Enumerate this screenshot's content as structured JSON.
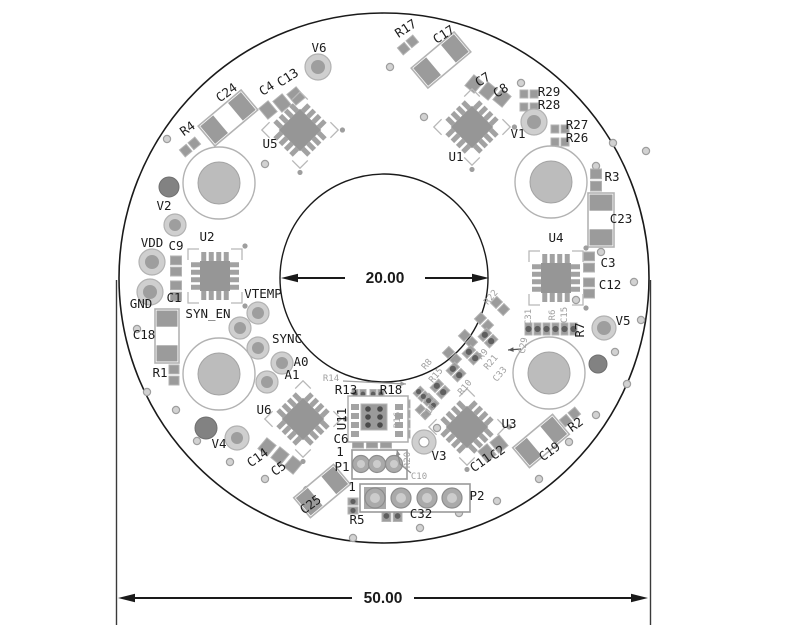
{
  "drawing_type": "pcb-assembly-drawing",
  "dimensions": {
    "inner_diameter": {
      "label": "20.00"
    },
    "outer_diameter": {
      "label": "50.00"
    }
  },
  "colors": {
    "background": "#ffffff",
    "board_outline": "#1a1a1a",
    "component_grey": "#9b9b9b",
    "component_light": "#b3b3b3",
    "pad_dark": "#5f5f5f",
    "silk_black": "#1c1c1c",
    "silk_grey": "#a0a0a0",
    "hole_fill": "#bcbcbc",
    "dim_black": "#1a1a1a"
  },
  "board": {
    "cx": 384,
    "cy": 278,
    "outer_r": 265,
    "inner_r": 104,
    "mount_holes": [
      [
        219,
        183
      ],
      [
        551,
        182
      ],
      [
        219,
        374
      ],
      [
        549,
        373
      ]
    ],
    "dark_circles": [
      [
        169,
        187,
        10
      ],
      [
        206,
        428,
        11
      ],
      [
        598,
        364,
        9
      ]
    ],
    "vias": [
      [
        167,
        139
      ],
      [
        265,
        164
      ],
      [
        390,
        67
      ],
      [
        443,
        65
      ],
      [
        521,
        83
      ],
      [
        424,
        117
      ],
      [
        613,
        143
      ],
      [
        646,
        151
      ],
      [
        596,
        166
      ],
      [
        601,
        252
      ],
      [
        634,
        282
      ],
      [
        641,
        320
      ],
      [
        615,
        352
      ],
      [
        576,
        300
      ],
      [
        137,
        329
      ],
      [
        147,
        392
      ],
      [
        176,
        410
      ],
      [
        197,
        441
      ],
      [
        230,
        462
      ],
      [
        265,
        479
      ],
      [
        307,
        490
      ],
      [
        353,
        538
      ],
      [
        420,
        528
      ],
      [
        459,
        513
      ],
      [
        497,
        501
      ],
      [
        539,
        479
      ],
      [
        569,
        442
      ],
      [
        596,
        415
      ],
      [
        627,
        384
      ],
      [
        437,
        428
      ]
    ]
  },
  "dims": {
    "inner": {
      "y": 278,
      "x1": 281,
      "x2": 489,
      "gap1": 345,
      "gap2": 425,
      "tx": 385,
      "ty": 283
    },
    "outer": {
      "y": 598,
      "x1": 118,
      "x2": 648,
      "gap1": 352,
      "gap2": 414,
      "tx": 383,
      "ty": 603,
      "ext": [
        {
          "x": 116.5,
          "y1": 280,
          "y2": 625
        },
        {
          "x": 650.5,
          "y1": 280,
          "y2": 625
        }
      ]
    }
  },
  "ics": [
    {
      "n": "U5",
      "x": 300,
      "y": 130,
      "r": 45
    },
    {
      "n": "U1",
      "x": 472,
      "y": 127,
      "r": 45
    },
    {
      "n": "U2",
      "x": 215,
      "y": 276,
      "r": 0
    },
    {
      "n": "U4",
      "x": 556,
      "y": 278,
      "r": 0
    },
    {
      "n": "U6",
      "x": 303,
      "y": 419,
      "r": 45
    },
    {
      "n": "U3",
      "x": 467,
      "y": 427,
      "r": 45
    }
  ],
  "big_caps": [
    {
      "n": "C17",
      "x": 441,
      "y": 60,
      "w": 56,
      "h": 26,
      "r": -40
    },
    {
      "n": "C24",
      "x": 228,
      "y": 118,
      "w": 56,
      "h": 26,
      "r": -40
    },
    {
      "n": "C18",
      "x": 167,
      "y": 336,
      "w": 54,
      "h": 24,
      "r": 90
    },
    {
      "n": "C23",
      "x": 601,
      "y": 220,
      "w": 54,
      "h": 26,
      "r": 90
    },
    {
      "n": "C19",
      "x": 541,
      "y": 441,
      "w": 52,
      "h": 26,
      "r": -40
    },
    {
      "n": "C25",
      "x": 322,
      "y": 491,
      "w": 52,
      "h": 26,
      "r": -40
    }
  ],
  "parts": [
    [
      408,
      45,
      -40,
      20,
      9,
      0
    ],
    [
      190,
      147,
      -40,
      20,
      9,
      0
    ],
    [
      268,
      110,
      -40,
      12,
      14,
      2
    ],
    [
      282,
      103,
      -40,
      12,
      14,
      2
    ],
    [
      296,
      96,
      -40,
      12,
      14,
      2
    ],
    [
      474,
      84,
      40,
      12,
      14,
      2
    ],
    [
      488,
      91,
      40,
      12,
      14,
      2
    ],
    [
      502,
      98,
      40,
      12,
      14,
      2
    ],
    [
      529,
      94,
      0,
      18,
      8,
      0
    ],
    [
      529,
      107,
      0,
      18,
      8,
      0
    ],
    [
      560,
      129,
      0,
      18,
      8,
      0
    ],
    [
      560,
      142,
      0,
      18,
      8,
      0
    ],
    [
      596,
      180,
      90,
      22,
      11,
      0
    ],
    [
      589,
      262,
      90,
      20,
      11,
      0
    ],
    [
      589,
      288,
      90,
      20,
      11,
      0
    ],
    [
      176,
      266,
      90,
      20,
      11,
      0
    ],
    [
      176,
      291,
      90,
      20,
      11,
      0
    ],
    [
      174,
      375,
      90,
      20,
      10,
      0
    ],
    [
      359,
      394,
      0,
      14,
      9,
      1
    ],
    [
      377,
      394,
      0,
      14,
      9,
      1
    ],
    [
      358,
      443,
      0,
      11,
      10,
      2
    ],
    [
      372,
      443,
      0,
      11,
      10,
      2
    ],
    [
      386,
      443,
      0,
      11,
      10,
      2
    ],
    [
      392,
      516,
      0,
      20,
      11,
      1
    ],
    [
      353,
      506,
      90,
      16,
      10,
      1
    ],
    [
      267,
      447,
      40,
      12,
      14,
      2
    ],
    [
      280,
      456,
      40,
      12,
      14,
      2
    ],
    [
      293,
      465,
      40,
      12,
      14,
      2
    ],
    [
      487,
      453,
      -40,
      12,
      14,
      2
    ],
    [
      499,
      444,
      -40,
      12,
      14,
      2
    ],
    [
      570,
      417,
      -40,
      20,
      9,
      0
    ],
    [
      533,
      329,
      0,
      16,
      12,
      1
    ],
    [
      551,
      329,
      0,
      16,
      12,
      1
    ],
    [
      569,
      329,
      0,
      16,
      12,
      1
    ],
    [
      500,
      306,
      45,
      18,
      9,
      0
    ],
    [
      484,
      322,
      45,
      18,
      9,
      0
    ],
    [
      468,
      339,
      45,
      18,
      9,
      0
    ],
    [
      452,
      356,
      45,
      18,
      9,
      0
    ],
    [
      488,
      338,
      45,
      16,
      12,
      1
    ],
    [
      472,
      355,
      45,
      16,
      12,
      1
    ],
    [
      456,
      372,
      45,
      16,
      12,
      1
    ],
    [
      440,
      389,
      45,
      16,
      12,
      1
    ],
    [
      431,
      401,
      45,
      14,
      8,
      0
    ],
    [
      423,
      412,
      45,
      14,
      8,
      0
    ],
    [
      421,
      394,
      45,
      12,
      10,
      1
    ],
    [
      431,
      403,
      45,
      12,
      10,
      1
    ],
    [
      404,
      404,
      0,
      12,
      8,
      2
    ],
    [
      404,
      414,
      0,
      12,
      8,
      2
    ],
    [
      404,
      424,
      0,
      12,
      8,
      2
    ],
    [
      404,
      434,
      0,
      12,
      8,
      2
    ]
  ],
  "round_pads": [
    {
      "n": "V6",
      "x": 318,
      "y": 67,
      "ro": 13,
      "ri": 7,
      "s": 0
    },
    {
      "n": "V1",
      "x": 534,
      "y": 122,
      "ro": 13,
      "ri": 7,
      "s": 0
    },
    {
      "n": "V2",
      "x": 175,
      "y": 225,
      "ro": 11,
      "ri": 6,
      "s": 0
    },
    {
      "n": "V5",
      "x": 604,
      "y": 328,
      "ro": 12,
      "ri": 7,
      "s": 0
    },
    {
      "n": "V4",
      "x": 237,
      "y": 438,
      "ro": 12,
      "ri": 6,
      "s": 0
    },
    {
      "n": "V3",
      "x": 424,
      "y": 442,
      "ro": 12,
      "ri": 5,
      "s": 1
    },
    {
      "n": "VDD",
      "x": 152,
      "y": 262,
      "ro": 13,
      "ri": 7,
      "s": 0
    },
    {
      "n": "GND",
      "x": 150,
      "y": 292,
      "ro": 13,
      "ri": 7,
      "s": 0
    },
    {
      "n": "VTEMP",
      "x": 258,
      "y": 313,
      "ro": 11,
      "ri": 6,
      "s": 0
    },
    {
      "n": "SYN_EN",
      "x": 240,
      "y": 328,
      "ro": 11,
      "ri": 6,
      "s": 0
    },
    {
      "n": "SYNC",
      "x": 258,
      "y": 348,
      "ro": 11,
      "ri": 6,
      "s": 0
    },
    {
      "n": "A0",
      "x": 282,
      "y": 363,
      "ro": 11,
      "ri": 6,
      "s": 0
    },
    {
      "n": "A1",
      "x": 267,
      "y": 382,
      "ro": 11,
      "ri": 6,
      "s": 0
    }
  ],
  "connectors": {
    "p1": {
      "box": [
        352,
        450,
        55,
        29
      ],
      "pads": [
        [
          361,
          464
        ],
        [
          377,
          464
        ],
        [
          394,
          464
        ]
      ],
      "ro": 8.5,
      "ri": 4
    },
    "p2": {
      "box": [
        360,
        484,
        110,
        28
      ],
      "pads": [
        [
          375,
          498
        ],
        [
          401,
          498
        ],
        [
          427,
          498
        ],
        [
          452,
          498
        ]
      ],
      "ro": 10,
      "ri": 5
    },
    "u11": {
      "box": [
        348,
        396,
        60,
        46
      ]
    }
  },
  "leaders": [
    {
      "pts": [
        [
          343,
          381
        ],
        [
          406,
          384
        ]
      ],
      "c": "#9d9d9d"
    },
    {
      "pts": [
        [
          411,
          473
        ],
        [
          400,
          464
        ],
        [
          397,
          450
        ]
      ],
      "c": "#8b8b8b"
    },
    {
      "pts": [
        [
          521,
          349
        ],
        [
          508,
          350
        ]
      ],
      "c": "#555555"
    }
  ],
  "labels": [
    {
      "t": "V6",
      "x": 319,
      "y": 52
    },
    {
      "t": "R17",
      "x": 408,
      "y": 32,
      "r": -33
    },
    {
      "t": "C17",
      "x": 446,
      "y": 38,
      "r": -33
    },
    {
      "t": "C7",
      "x": 485,
      "y": 83,
      "r": -33
    },
    {
      "t": "C8",
      "x": 503,
      "y": 94,
      "r": -33
    },
    {
      "t": "R29",
      "x": 549,
      "y": 96
    },
    {
      "t": "R28",
      "x": 549,
      "y": 109
    },
    {
      "t": "R27",
      "x": 577,
      "y": 129
    },
    {
      "t": "R26",
      "x": 577,
      "y": 142
    },
    {
      "t": "V1",
      "x": 518,
      "y": 138
    },
    {
      "t": "U1",
      "x": 456,
      "y": 161
    },
    {
      "t": "R3",
      "x": 612,
      "y": 181
    },
    {
      "t": "C23",
      "x": 621,
      "y": 223
    },
    {
      "t": "C4",
      "x": 269,
      "y": 92,
      "r": -33
    },
    {
      "t": "C13",
      "x": 290,
      "y": 81,
      "r": -33
    },
    {
      "t": "C24",
      "x": 229,
      "y": 96,
      "r": -36
    },
    {
      "t": "R4",
      "x": 190,
      "y": 132,
      "r": -36
    },
    {
      "t": "U5",
      "x": 270,
      "y": 148
    },
    {
      "t": "V2",
      "x": 164,
      "y": 210
    },
    {
      "t": "VDD",
      "x": 152,
      "y": 247
    },
    {
      "t": "C9",
      "x": 176,
      "y": 250
    },
    {
      "t": "U2",
      "x": 207,
      "y": 241
    },
    {
      "t": "GND",
      "x": 141,
      "y": 308
    },
    {
      "t": "C1",
      "x": 174,
      "y": 302
    },
    {
      "t": "SYN_EN",
      "x": 208,
      "y": 318
    },
    {
      "t": "C18",
      "x": 144,
      "y": 339
    },
    {
      "t": "R1",
      "x": 160,
      "y": 377
    },
    {
      "t": "VTEMP",
      "x": 263,
      "y": 298
    },
    {
      "t": "SYNC",
      "x": 287,
      "y": 343
    },
    {
      "t": "A0",
      "x": 301,
      "y": 366
    },
    {
      "t": "A1",
      "x": 292,
      "y": 379
    },
    {
      "t": "U6",
      "x": 264,
      "y": 414
    },
    {
      "t": "V4",
      "x": 219,
      "y": 448
    },
    {
      "t": "C14",
      "x": 260,
      "y": 461,
      "r": -36
    },
    {
      "t": "C5",
      "x": 281,
      "y": 472,
      "r": -36
    },
    {
      "t": "C25",
      "x": 313,
      "y": 508,
      "r": -36
    },
    {
      "t": "R5",
      "x": 357,
      "y": 524
    },
    {
      "t": "C6",
      "x": 341,
      "y": 443
    },
    {
      "t": "1",
      "x": 340,
      "y": 456
    },
    {
      "t": "P1",
      "x": 342,
      "y": 471
    },
    {
      "t": "1",
      "x": 352,
      "y": 491
    },
    {
      "t": "P2",
      "x": 477,
      "y": 500
    },
    {
      "t": "C32",
      "x": 421,
      "y": 518
    },
    {
      "t": "R13",
      "x": 346,
      "y": 394
    },
    {
      "t": "R18",
      "x": 391,
      "y": 394
    },
    {
      "t": "V3",
      "x": 439,
      "y": 460
    },
    {
      "t": "U3",
      "x": 509,
      "y": 428
    },
    {
      "t": "C11",
      "x": 483,
      "y": 466,
      "r": -36
    },
    {
      "t": "C2",
      "x": 500,
      "y": 456,
      "r": -36
    },
    {
      "t": "C19",
      "x": 552,
      "y": 455,
      "r": -36
    },
    {
      "t": "R2",
      "x": 578,
      "y": 428,
      "r": -36
    },
    {
      "t": "U4",
      "x": 556,
      "y": 242
    },
    {
      "t": "C3",
      "x": 608,
      "y": 267
    },
    {
      "t": "C12",
      "x": 610,
      "y": 289
    },
    {
      "t": "R7",
      "x": 584,
      "y": 330,
      "r": -90
    },
    {
      "t": "V5",
      "x": 623,
      "y": 325
    },
    {
      "t": "U11",
      "x": 346,
      "y": 419,
      "r": -90
    },
    {
      "t": "R14",
      "x": 331,
      "y": 381,
      "k": "g"
    },
    {
      "t": "R16",
      "x": 400,
      "y": 420,
      "r": -90,
      "k": "g"
    },
    {
      "t": "R20",
      "x": 410,
      "y": 460,
      "r": -90,
      "k": "g"
    },
    {
      "t": "C10",
      "x": 419,
      "y": 479,
      "k": "g"
    },
    {
      "t": "C31",
      "x": 531,
      "y": 317,
      "r": -90,
      "k": "g"
    },
    {
      "t": "R6",
      "x": 555,
      "y": 315,
      "r": -90,
      "k": "g"
    },
    {
      "t": "C15",
      "x": 567,
      "y": 315,
      "r": -90,
      "k": "g"
    },
    {
      "t": "C29",
      "x": 526,
      "y": 346,
      "r": -80,
      "k": "g"
    },
    {
      "t": "R9",
      "x": 485,
      "y": 356,
      "r": -50,
      "k": "g"
    },
    {
      "t": "R21",
      "x": 493,
      "y": 364,
      "r": -50,
      "k": "g"
    },
    {
      "t": "C33",
      "x": 502,
      "y": 376,
      "r": -50,
      "k": "g"
    },
    {
      "t": "R8",
      "x": 429,
      "y": 366,
      "r": -50,
      "k": "g"
    },
    {
      "t": "R15",
      "x": 438,
      "y": 377,
      "r": -50,
      "k": "g"
    },
    {
      "t": "R10",
      "x": 467,
      "y": 389,
      "r": -50,
      "k": "g"
    },
    {
      "t": "R11",
      "x": 431,
      "y": 413,
      "r": -50,
      "k": "g"
    },
    {
      "t": "R22",
      "x": 493,
      "y": 299,
      "r": -50,
      "k": "g"
    }
  ]
}
